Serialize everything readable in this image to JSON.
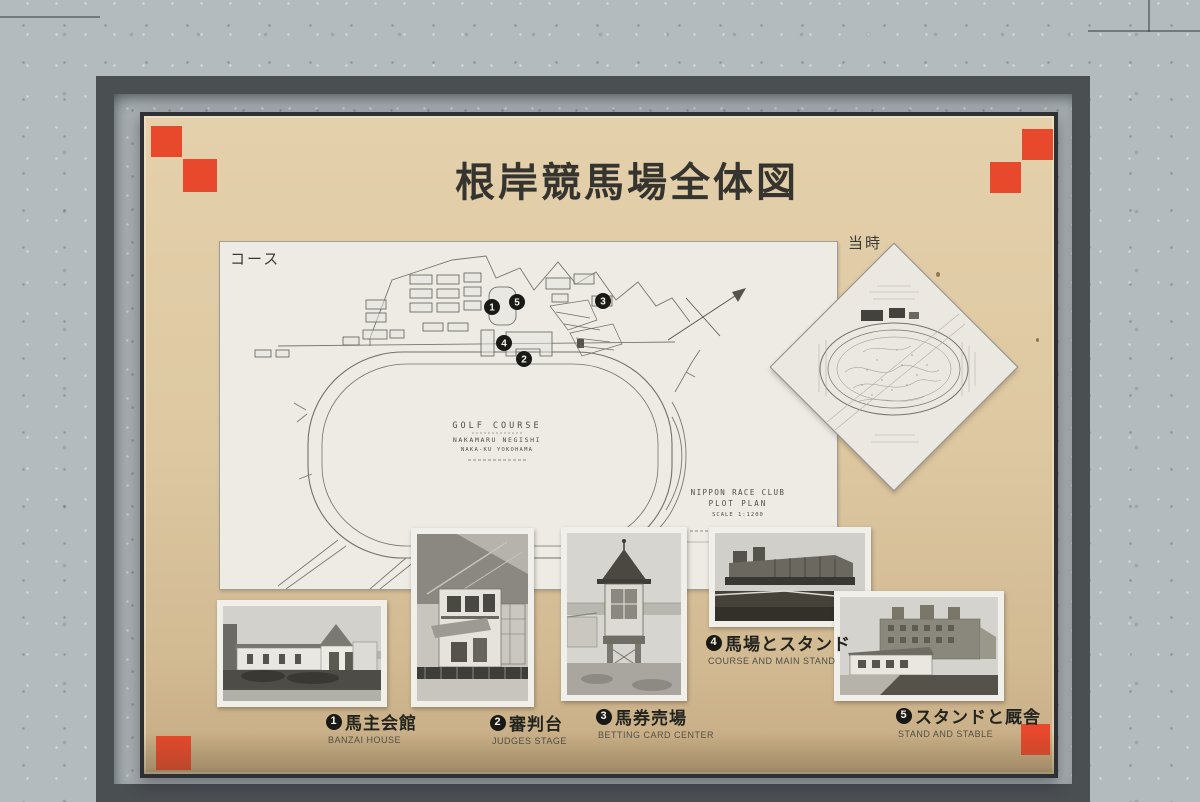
{
  "board": {
    "title": "根岸競馬場全体図",
    "course_label": "コース",
    "old_map_label": "当時"
  },
  "plan": {
    "center_text": [
      "GOLF COURSE",
      "NAKAMARU NEGISHI",
      "NAKA-KU YOKOHAMA"
    ],
    "corner_text": [
      "NIPPON RACE CLUB",
      "PLOT PLAN",
      "SCALE 1:1200"
    ],
    "markers": [
      {
        "number": "1"
      },
      {
        "number": "2"
      },
      {
        "number": "3"
      },
      {
        "number": "4"
      },
      {
        "number": "5"
      }
    ]
  },
  "photos": [
    {
      "number": "1",
      "caption_jp": "馬主会館",
      "caption_en": "BANZAI HOUSE"
    },
    {
      "number": "2",
      "caption_jp": "審判台",
      "caption_en": "JUDGES STAGE"
    },
    {
      "number": "3",
      "caption_jp": "馬券売場",
      "caption_en": "BETTING CARD CENTER"
    },
    {
      "number": "4",
      "caption_jp": "馬場とスタンド",
      "caption_en": "COURSE AND MAIN STAND"
    },
    {
      "number": "5",
      "caption_jp": "スタンドと厩舎",
      "caption_en": "STAND AND STABLE"
    }
  ],
  "colors": {
    "board_tan": "#ddc8a1",
    "corner_red": "#e8482c",
    "wall_gray": "#b4bbbe",
    "frame_dark": "#2e3133",
    "paper_white": "#edebe4"
  }
}
